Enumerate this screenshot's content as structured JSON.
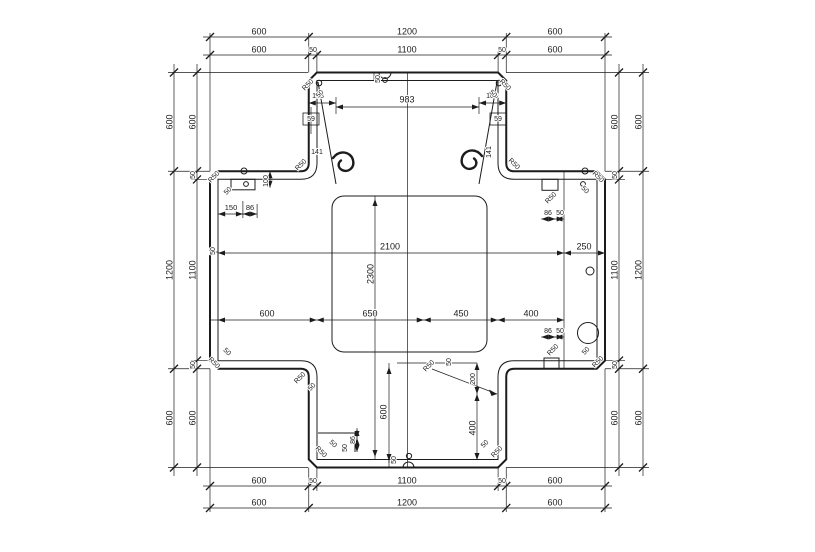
{
  "drawing": {
    "type": "dimensioned-plan-cross-shaped-slab",
    "background": "#ffffff",
    "line_color": "#1c1c1c",
    "dim_labels": [
      {
        "t": "600",
        "x": 259,
        "y": 32
      },
      {
        "t": "1200",
        "x": 407,
        "y": 32
      },
      {
        "t": "600",
        "x": 555,
        "y": 32
      },
      {
        "t": "600",
        "x": 259,
        "y": 50
      },
      {
        "t": "50",
        "x": 313,
        "y": 50,
        "s": 7
      },
      {
        "t": "1100",
        "x": 407,
        "y": 50
      },
      {
        "t": "50",
        "x": 502,
        "y": 50,
        "s": 7
      },
      {
        "t": "600",
        "x": 555,
        "y": 50
      },
      {
        "t": "600",
        "x": 259,
        "y": 481
      },
      {
        "t": "50",
        "x": 313,
        "y": 481,
        "s": 7
      },
      {
        "t": "1100",
        "x": 407,
        "y": 481
      },
      {
        "t": "50",
        "x": 502,
        "y": 481,
        "s": 7
      },
      {
        "t": "600",
        "x": 555,
        "y": 481
      },
      {
        "t": "600",
        "x": 259,
        "y": 503
      },
      {
        "t": "1200",
        "x": 407,
        "y": 503
      },
      {
        "t": "600",
        "x": 555,
        "y": 503
      },
      {
        "t": "600",
        "x": 170,
        "y": 122,
        "r": -90
      },
      {
        "t": "1200",
        "x": 170,
        "y": 270,
        "r": -90
      },
      {
        "t": "600",
        "x": 170,
        "y": 418,
        "r": -90
      },
      {
        "t": "600",
        "x": 193,
        "y": 122,
        "r": -90
      },
      {
        "t": "50",
        "x": 193,
        "y": 175,
        "r": -90,
        "s": 7
      },
      {
        "t": "1100",
        "x": 193,
        "y": 270,
        "r": -90
      },
      {
        "t": "50",
        "x": 193,
        "y": 365,
        "r": -90,
        "s": 7
      },
      {
        "t": "600",
        "x": 193,
        "y": 418,
        "r": -90
      },
      {
        "t": "600",
        "x": 615,
        "y": 122,
        "r": -90
      },
      {
        "t": "50",
        "x": 615,
        "y": 175,
        "r": -90,
        "s": 7
      },
      {
        "t": "1100",
        "x": 615,
        "y": 270,
        "r": -90
      },
      {
        "t": "50",
        "x": 615,
        "y": 365,
        "r": -90,
        "s": 7
      },
      {
        "t": "600",
        "x": 615,
        "y": 418,
        "r": -90
      },
      {
        "t": "600",
        "x": 639,
        "y": 122,
        "r": -90
      },
      {
        "t": "1200",
        "x": 639,
        "y": 270,
        "r": -90
      },
      {
        "t": "600",
        "x": 639,
        "y": 418,
        "r": -90
      },
      {
        "t": "983",
        "x": 407,
        "y": 100
      },
      {
        "t": "108",
        "x": 318,
        "y": 96,
        "s": 7
      },
      {
        "t": "108",
        "x": 492,
        "y": 96,
        "s": 7
      },
      {
        "t": "59",
        "x": 311,
        "y": 119,
        "s": 7
      },
      {
        "t": "59",
        "x": 498,
        "y": 119,
        "s": 7
      },
      {
        "t": "141",
        "x": 317,
        "y": 152,
        "s": 7
      },
      {
        "t": "141",
        "x": 489,
        "y": 152,
        "r": -90,
        "s": 7
      },
      {
        "t": "150",
        "x": 231,
        "y": 208,
        "s": 7.5
      },
      {
        "t": "86",
        "x": 250,
        "y": 208,
        "s": 7.5
      },
      {
        "t": "100",
        "x": 266,
        "y": 181,
        "r": -90,
        "s": 7
      },
      {
        "t": "86",
        "x": 548,
        "y": 213,
        "s": 7
      },
      {
        "t": "50",
        "x": 560,
        "y": 213,
        "s": 7
      },
      {
        "t": "2100",
        "x": 390,
        "y": 247
      },
      {
        "t": "250",
        "x": 584,
        "y": 247
      },
      {
        "t": "2300",
        "x": 371,
        "y": 274,
        "r": -90
      },
      {
        "t": "600",
        "x": 267,
        "y": 314
      },
      {
        "t": "650",
        "x": 370,
        "y": 314
      },
      {
        "t": "450",
        "x": 461,
        "y": 314
      },
      {
        "t": "400",
        "x": 531,
        "y": 314
      },
      {
        "t": "86",
        "x": 548,
        "y": 331,
        "s": 7
      },
      {
        "t": "50",
        "x": 560,
        "y": 331,
        "s": 7
      },
      {
        "t": "600",
        "x": 384,
        "y": 412,
        "r": -90
      },
      {
        "t": "200",
        "x": 473,
        "y": 379,
        "r": -90,
        "s": 7
      },
      {
        "t": "400",
        "x": 473,
        "y": 428,
        "r": -90
      },
      {
        "t": "50",
        "x": 449,
        "y": 362,
        "r": -90,
        "s": 7
      },
      {
        "t": "86",
        "x": 353,
        "y": 440,
        "r": -90,
        "s": 7
      },
      {
        "t": "50",
        "x": 345,
        "y": 448,
        "r": -90,
        "s": 7
      },
      {
        "t": "50",
        "x": 378,
        "y": 79,
        "r": -90,
        "s": 7
      },
      {
        "t": "50",
        "x": 213,
        "y": 251,
        "r": -90,
        "s": 7
      },
      {
        "t": "50",
        "x": 394,
        "y": 460,
        "r": -90,
        "s": 7
      },
      {
        "t": "R50",
        "x": 308,
        "y": 85,
        "r": -45,
        "s": 7
      },
      {
        "t": "50",
        "x": 320,
        "y": 94,
        "r": -45,
        "s": 7
      },
      {
        "t": "R50",
        "x": 505,
        "y": 85,
        "r": 45,
        "s": 7
      },
      {
        "t": "50",
        "x": 493,
        "y": 94,
        "r": 45,
        "s": 7
      },
      {
        "t": "R50",
        "x": 301,
        "y": 165,
        "r": -45,
        "s": 7
      },
      {
        "t": "R50",
        "x": 514,
        "y": 164,
        "r": 45,
        "s": 7
      },
      {
        "t": "R50",
        "x": 214,
        "y": 177,
        "r": -45,
        "s": 7
      },
      {
        "t": "50",
        "x": 228,
        "y": 191,
        "r": -45,
        "s": 7
      },
      {
        "t": "R50",
        "x": 598,
        "y": 177,
        "r": 45,
        "s": 7
      },
      {
        "t": "50",
        "x": 585,
        "y": 190,
        "r": 45,
        "s": 7
      },
      {
        "t": "R50",
        "x": 551,
        "y": 198,
        "r": -45,
        "s": 7
      },
      {
        "t": "R50",
        "x": 214,
        "y": 363,
        "r": 45,
        "s": 7
      },
      {
        "t": "50",
        "x": 227,
        "y": 352,
        "r": 45,
        "s": 7
      },
      {
        "t": "R50",
        "x": 300,
        "y": 378,
        "r": -45,
        "s": 7
      },
      {
        "t": "50",
        "x": 312,
        "y": 387,
        "r": -45,
        "s": 7
      },
      {
        "t": "R50",
        "x": 598,
        "y": 362,
        "r": -45,
        "s": 7
      },
      {
        "t": "50",
        "x": 586,
        "y": 351,
        "r": -45,
        "s": 7
      },
      {
        "t": "R50",
        "x": 553,
        "y": 350,
        "r": -45,
        "s": 7
      },
      {
        "t": "R50",
        "x": 321,
        "y": 452,
        "r": 45,
        "s": 7
      },
      {
        "t": "50",
        "x": 333,
        "y": 444,
        "r": 45,
        "s": 7
      },
      {
        "t": "R50",
        "x": 497,
        "y": 452,
        "r": -45,
        "s": 7
      },
      {
        "t": "50",
        "x": 485,
        "y": 444,
        "r": -45,
        "s": 7
      },
      {
        "t": "R50",
        "x": 429,
        "y": 366,
        "r": -45,
        "s": 7
      }
    ]
  }
}
